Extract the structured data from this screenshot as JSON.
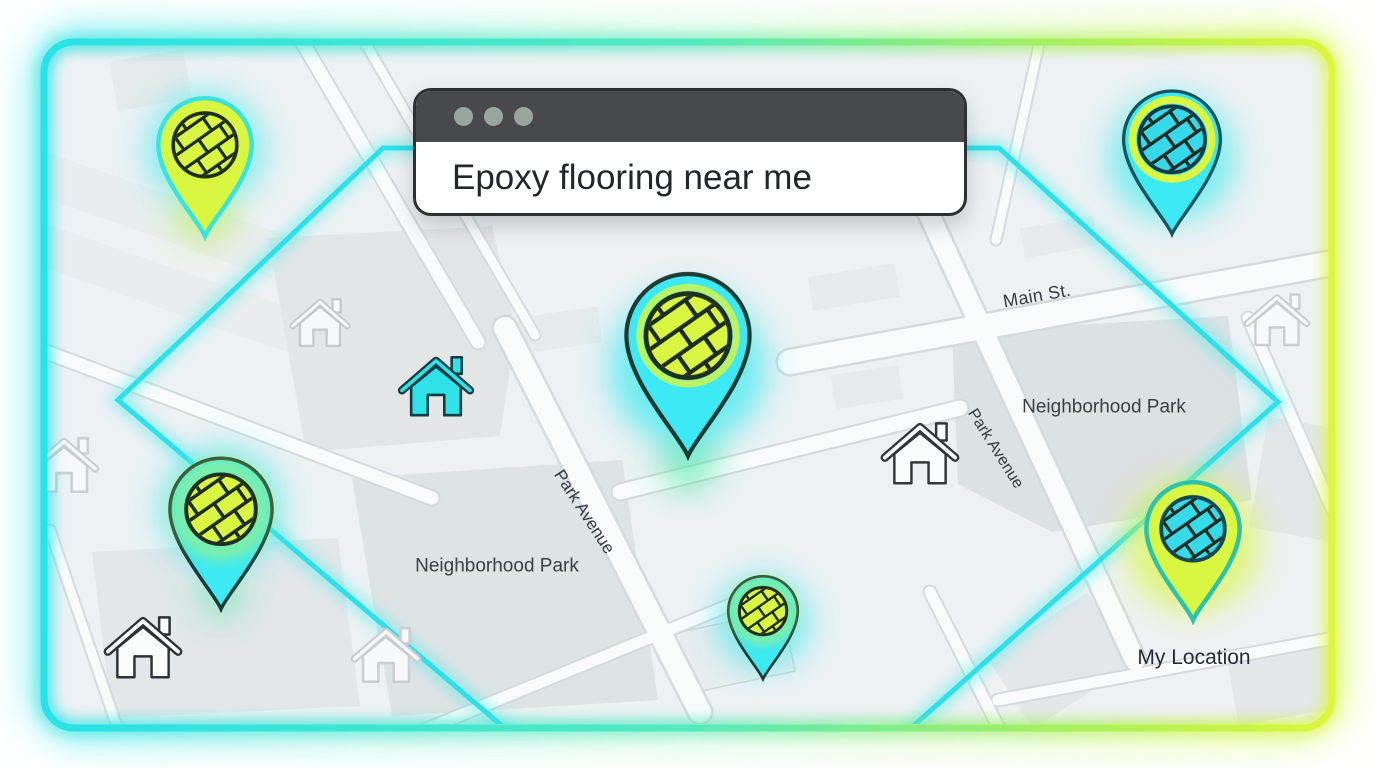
{
  "search_window": {
    "query": "Epoxy flooring near me",
    "window_controls": "three window dots"
  },
  "map": {
    "streets": {
      "main_st": "Main St.",
      "park_avenue_left": "Park Avenue",
      "park_avenue_right": "Park Avenue"
    },
    "parks": {
      "left": "Neighborhood Park",
      "right": "Neighborhood Park"
    },
    "my_location_label": "My Location",
    "pins": [
      {
        "id": "pin-top-left",
        "style": "lime pin, lime flooring circle, cyan outline"
      },
      {
        "id": "pin-top-right",
        "style": "cyan pin, cyan flooring circle, lime ring"
      },
      {
        "id": "pin-center-large",
        "style": "cyan pin, lime flooring circle"
      },
      {
        "id": "pin-mid-left",
        "style": "cyan pin, lime flooring circle"
      },
      {
        "id": "pin-bottom-center",
        "style": "cyan pin, lime flooring circle"
      },
      {
        "id": "pin-my-location",
        "style": "lime pin, cyan flooring circle"
      }
    ]
  },
  "icons": {
    "map_pin": "teardrop-location-marker-with-plank-flooring-pattern",
    "house": "house-outline-with-chimney",
    "window_dot": "window-control-dot"
  },
  "colors": {
    "cyan": "#3de9f4",
    "lime": "#d9f640",
    "frame_gradient_start": "#27e2e6",
    "frame_gradient_end": "#dcf63a",
    "titlebar": "#47494b",
    "map_background": "#edf1f3",
    "dark_outline": "#1d2d24",
    "text_dark": "#23262a"
  }
}
